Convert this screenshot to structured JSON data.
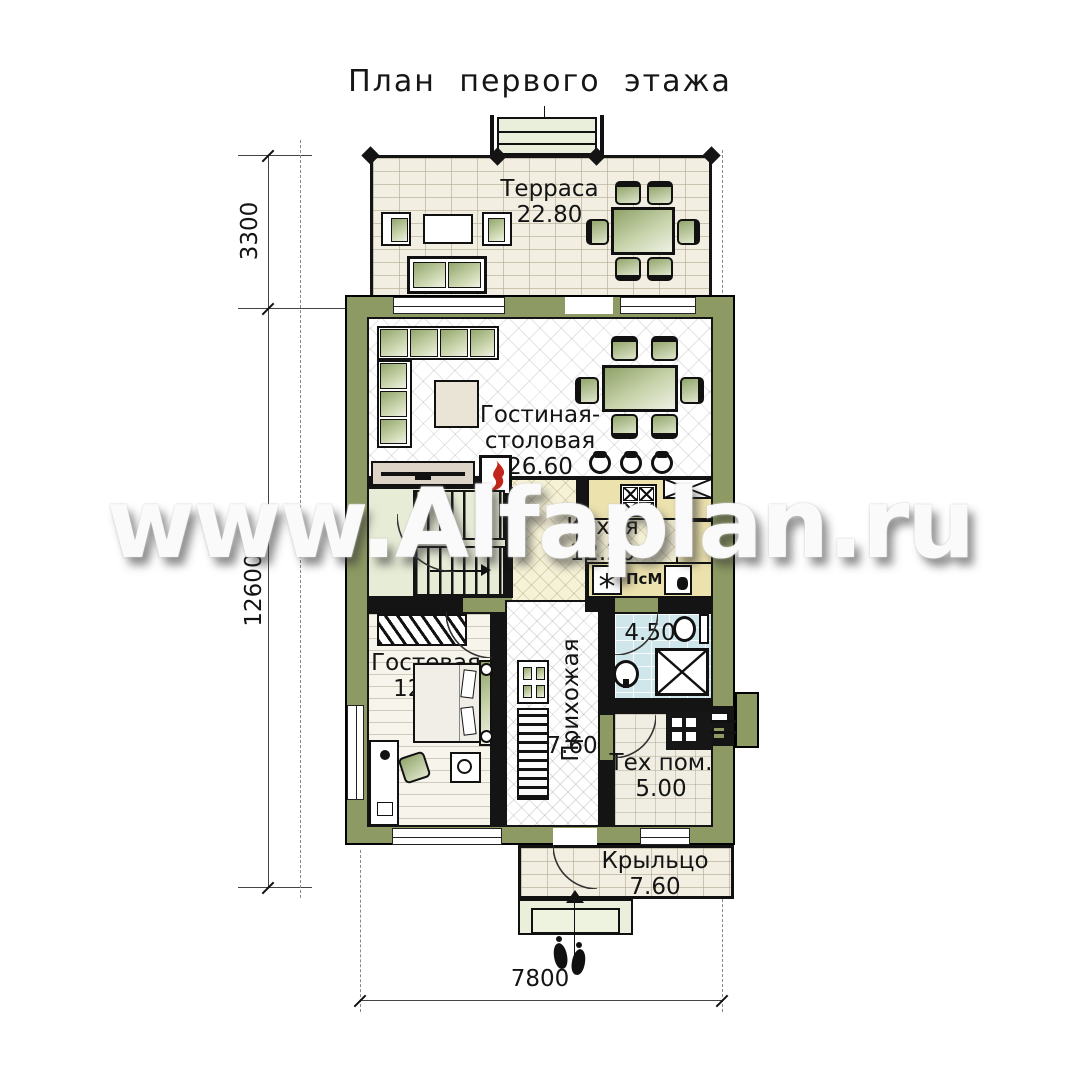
{
  "title": "План первого этажа",
  "watermark": "www.Alfaplan.ru",
  "rooms": {
    "terrace": {
      "label": "Терраса",
      "area": "22.80"
    },
    "living": {
      "label_line1": "Гостиная-",
      "label_line2": "столовая",
      "area": "26.60"
    },
    "kitchen": {
      "label": "Кухня",
      "area": "12.20"
    },
    "guest": {
      "label": "Гостевая",
      "area": "12.90"
    },
    "hallway": {
      "label": "Прихожая",
      "area": "7.60"
    },
    "bathroom": {
      "area": "4.50"
    },
    "tech": {
      "label": "Тех пом.",
      "area": "5.00"
    },
    "porch": {
      "label": "Крыльцо",
      "area": "7.60"
    }
  },
  "annotations": {
    "dishwasher_label": "ПсМ"
  },
  "dimensions": {
    "terrace_depth": "3300",
    "house_depth": "12600",
    "house_width": "7800"
  },
  "colors": {
    "wall": "#8d9a63",
    "furniture": "#9fae7d",
    "flame": "#c3271b",
    "bath_tile": "#cfe7ea"
  }
}
